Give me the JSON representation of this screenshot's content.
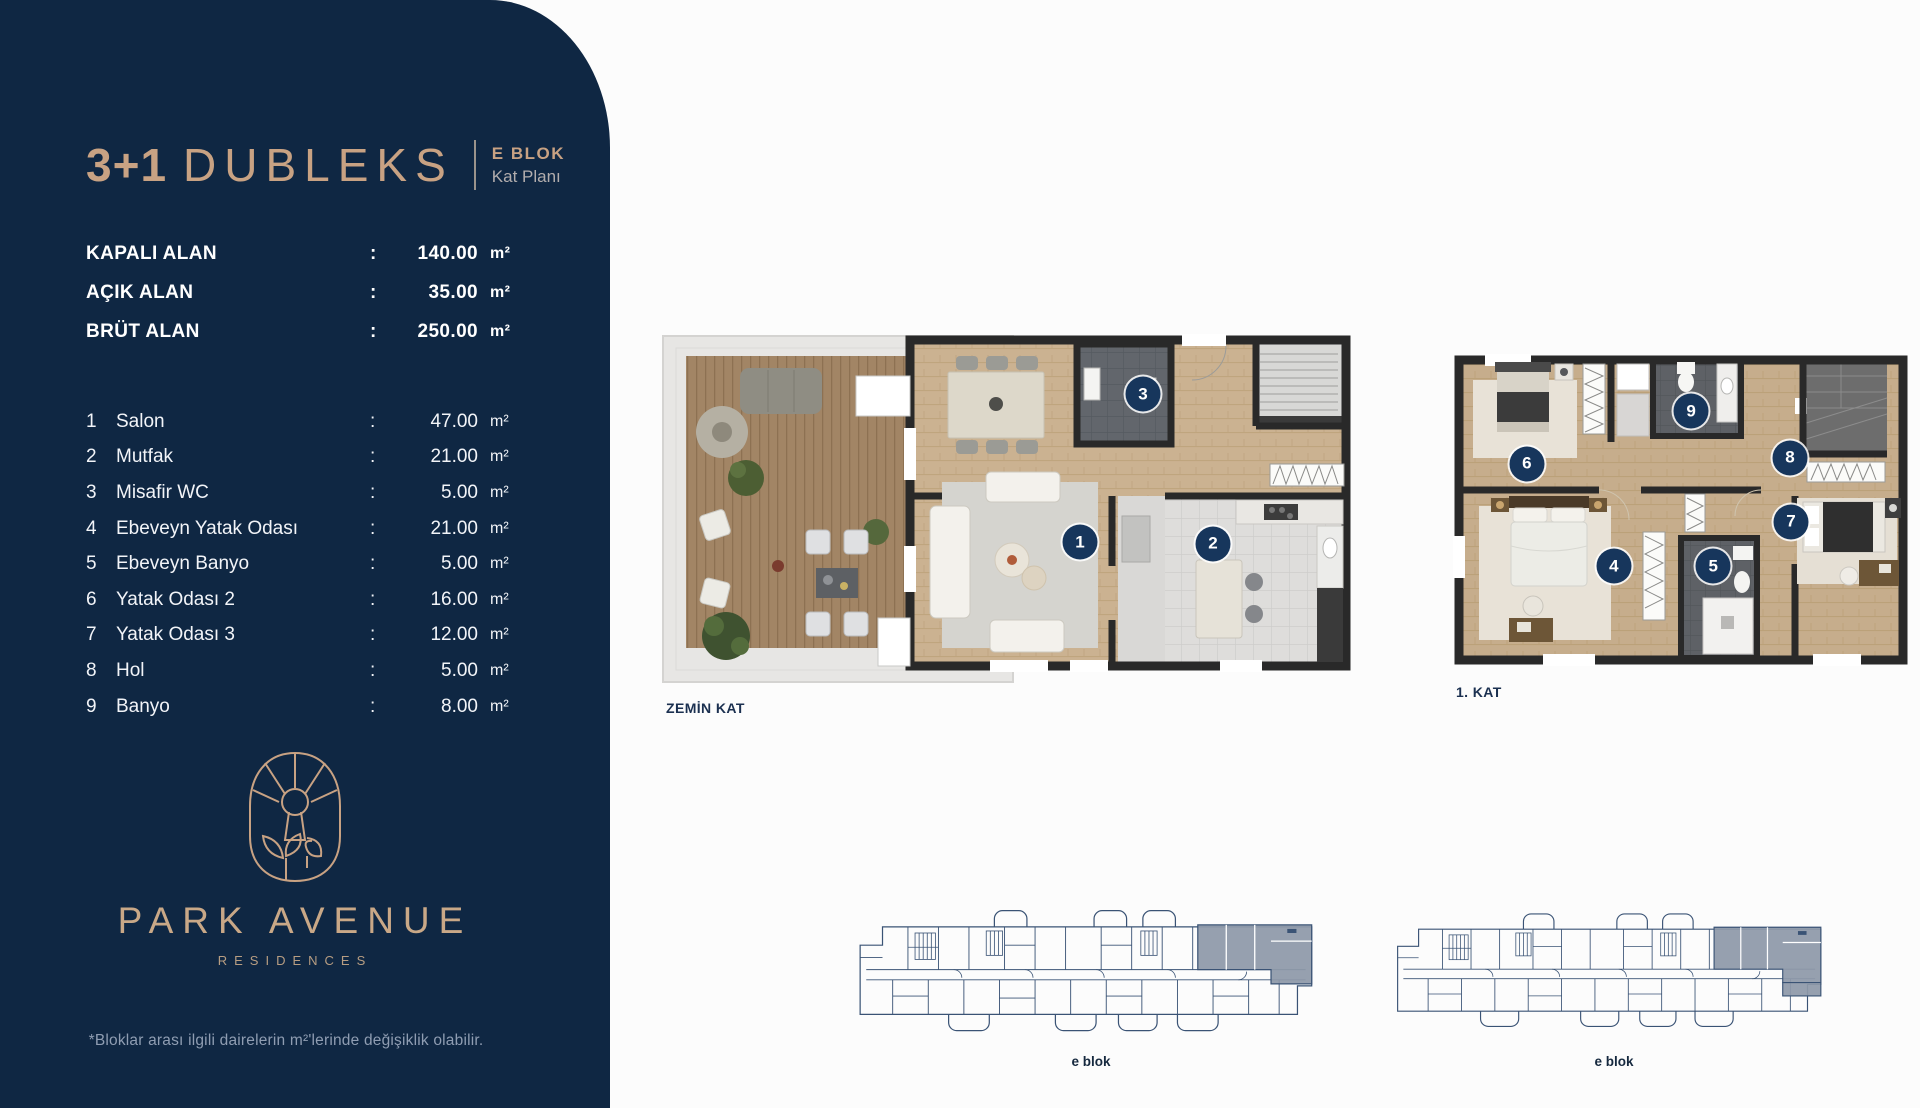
{
  "sidebar": {
    "title_number": "3+1",
    "title_word": "DUBLEKS",
    "block_label": "E BLOK",
    "block_sublabel": "Kat Planı",
    "areas": [
      {
        "label": "KAPALI ALAN",
        "sep": ":",
        "value": "140.00",
        "unit": "m²"
      },
      {
        "label": "AÇIK ALAN",
        "sep": ":",
        "value": "35.00",
        "unit": "m²"
      },
      {
        "label": "BRÜT ALAN",
        "sep": ":",
        "value": "250.00",
        "unit": "m²"
      }
    ],
    "rooms": [
      {
        "no": "1",
        "name": "Salon",
        "sep": ":",
        "value": "47.00",
        "unit": "m²"
      },
      {
        "no": "2",
        "name": "Mutfak",
        "sep": ":",
        "value": "21.00",
        "unit": "m²"
      },
      {
        "no": "3",
        "name": "Misafir WC",
        "sep": ":",
        "value": "5.00",
        "unit": "m²"
      },
      {
        "no": "4",
        "name": "Ebeveyn Yatak Odası",
        "sep": ":",
        "value": "21.00",
        "unit": "m²"
      },
      {
        "no": "5",
        "name": "Ebeveyn Banyo",
        "sep": ":",
        "value": "5.00",
        "unit": "m²"
      },
      {
        "no": "6",
        "name": "Yatak Odası 2",
        "sep": ":",
        "value": "16.00",
        "unit": "m²"
      },
      {
        "no": "7",
        "name": "Yatak Odası 3",
        "sep": ":",
        "value": "12.00",
        "unit": "m²"
      },
      {
        "no": "8",
        "name": "Hol",
        "sep": ":",
        "value": "5.00",
        "unit": "m²"
      },
      {
        "no": "9",
        "name": "Banyo",
        "sep": ":",
        "value": "8.00",
        "unit": "m²"
      }
    ],
    "brand": {
      "name": "PARK AVENUE",
      "subtitle": "RESIDENCES"
    },
    "footnote": "*Bloklar arası ilgili dairelerin m²'lerinde değişiklik olabilir."
  },
  "plans": {
    "ground": {
      "label": "ZEMİN KAT",
      "markers": [
        {
          "n": "1",
          "x": 60.0,
          "y": 59.7
        },
        {
          "n": "2",
          "x": 79.0,
          "y": 60.2
        },
        {
          "n": "3",
          "x": 69.0,
          "y": 19.9
        }
      ]
    },
    "first": {
      "label": "1. KAT",
      "markers": [
        {
          "n": "4",
          "x": 35.4,
          "y": 65.5
        },
        {
          "n": "5",
          "x": 57.0,
          "y": 65.5
        },
        {
          "n": "6",
          "x": 16.5,
          "y": 34.5
        },
        {
          "n": "7",
          "x": 73.9,
          "y": 52.1
        },
        {
          "n": "8",
          "x": 73.7,
          "y": 32.7
        },
        {
          "n": "9",
          "x": 52.2,
          "y": 18.5
        }
      ]
    },
    "blocks": [
      {
        "label": "e blok"
      },
      {
        "label": "e blok"
      }
    ]
  },
  "colors": {
    "sidebar_navy": "#0f2743",
    "gold_accent": "#c8a283",
    "marker_navy": "#17365c",
    "plan_label_navy": "#1b3050",
    "block_line_navy": "#3a5375",
    "highlight_gray": "#8e99a9"
  }
}
